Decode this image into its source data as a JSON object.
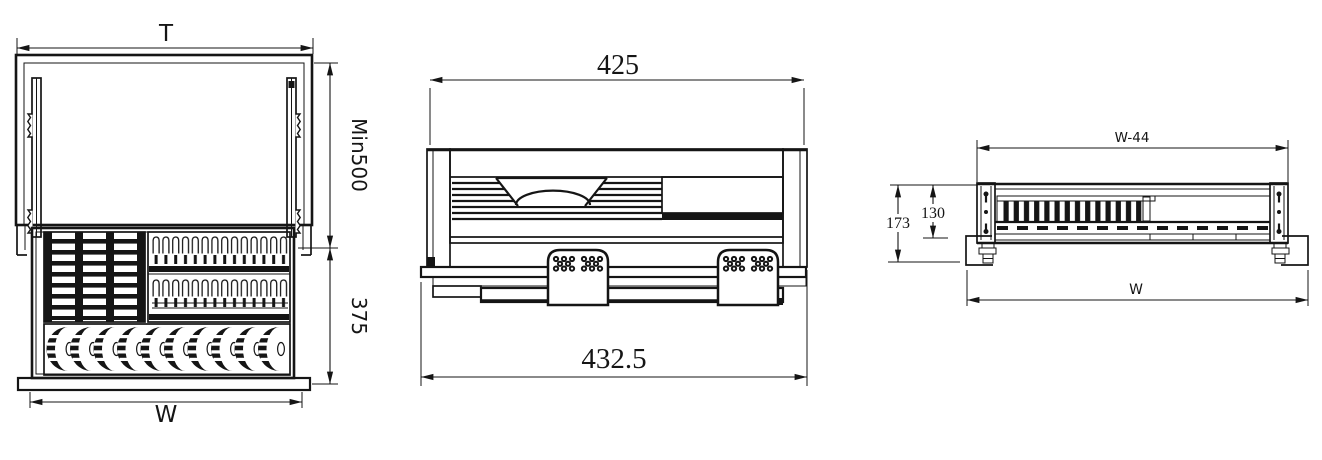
{
  "drawing": {
    "background": "#ffffff",
    "ink": "#151515",
    "views": {
      "top_view": {
        "dim_cabinet_width": "T",
        "dim_depth_min": "Min500",
        "dim_basket_depth": "375",
        "dim_opening_width": "W"
      },
      "front_view": {
        "dim_body_width": "425",
        "dim_overall_width": "432.5"
      },
      "side_view": {
        "dim_inner_width": "W-44",
        "dim_overall_height": "173",
        "dim_body_height": "130",
        "dim_overall_width": "W"
      }
    }
  }
}
